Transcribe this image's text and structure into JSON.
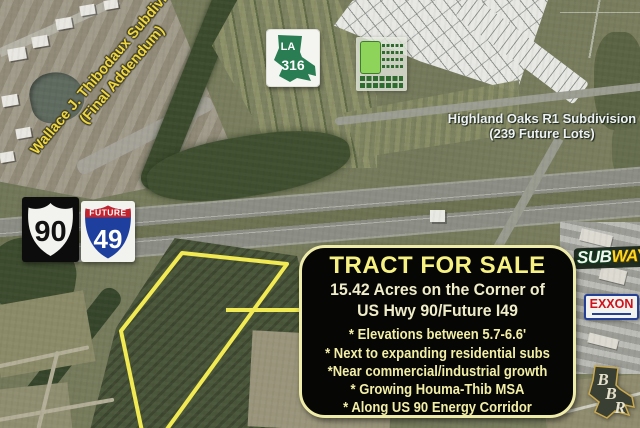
{
  "map_labels": {
    "wallace_line1": "Wallace J. Thibodaux Subdivision",
    "wallace_line2": "(Final Addendum)",
    "highland_line1": "Highland Oaks R1 Subdivision",
    "highland_line2": "(239 Future Lots)"
  },
  "shields": {
    "la316": {
      "state": "LA",
      "number": "316"
    },
    "us90": {
      "number": "90"
    },
    "i49": {
      "banner": "FUTURE",
      "number": "49"
    }
  },
  "logos": {
    "subway_part1": "SUB",
    "subway_part2": "WAY",
    "exxon": "EXXON",
    "bbr_b1": "B",
    "bbr_b2": "B",
    "bbr_r": "R"
  },
  "sale_box": {
    "title": "TRACT FOR SALE",
    "subtitle_line1": "15.42 Acres on the Corner of",
    "subtitle_line2": "US Hwy 90/Future I49",
    "bullets": [
      "* Elevations between 5.7-6.6'",
      "* Next to expanding residential subs",
      "*Near commercial/industrial growth",
      "* Growing Houma-Thib MSA",
      "* Along US 90 Energy Corridor"
    ]
  },
  "colors": {
    "tract_outline": "#f2ea52",
    "sale_box_border": "#efeba8",
    "sale_box_title": "#f6f180",
    "label_yellow": "#eed63d",
    "label_white": "#eef2f5"
  }
}
